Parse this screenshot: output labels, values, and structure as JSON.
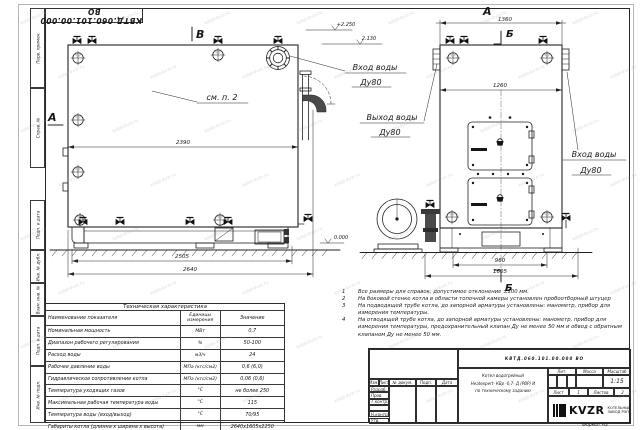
{
  "sheet": {
    "stamp_top": "КВТД.060.101.00.000 ВО",
    "format_label": "Формат  А3",
    "margin_labels": [
      "Перв. примен.",
      "Справ. №",
      "Подп. и дата",
      "Инв. № дубл.",
      "Взам. инв. №",
      "Подп. и дата",
      "Инв. № подл."
    ]
  },
  "watermark": {
    "text": "kotel-kvzr.ru"
  },
  "drawing": {
    "view_labels": {
      "b": "В",
      "a_side": "А",
      "a_front": "А",
      "sec": "Б"
    },
    "callouts": {
      "see_note": "см. п. 2",
      "inlet1": "Вход воды",
      "inlet2": "Ду80",
      "outlet1": "Выход воды",
      "outlet2": "Ду80",
      "inlet_right1": "Вход воды",
      "inlet_right2": "Ду80"
    },
    "dims": {
      "side_inner": "2390",
      "side_base": "2505",
      "side_total": "2640",
      "front_total": "1360",
      "front_inner": "1260",
      "front_base": "960",
      "front_overall": "1605"
    },
    "elevations": {
      "top": "+2.250",
      "mid": "2.130",
      "zero": "0.000"
    }
  },
  "notes": [
    {
      "num": "1",
      "text": "Все размеры для справок, допустимое отклонение ±100 мм."
    },
    {
      "num": "2",
      "text": "На боковой стенке котла в области топочной камеры установлен пробоотборный штуцер"
    },
    {
      "num": "3",
      "text": "На подводящей трубе котла, до запорной арматуры установлены: манометр, прибор для измерения температуры."
    },
    {
      "num": "4",
      "text": "На отводящей трубе котла, до запорной арматуры установлены: манометр, прибор для измерения температуры, предохранительный клапан Ду не менее 50 мм и обвод с обратным клапаном Ду не менее 50 мм."
    }
  ],
  "tech_table": {
    "title": "Техническая характеристика",
    "headers": {
      "name": "Наименование показателя",
      "units": "Единицы измерения",
      "value": "Значение"
    },
    "rows": [
      {
        "name": "Номинальная мощность",
        "units": "МВт",
        "value": "0,7"
      },
      {
        "name": "Диапазон рабочего регулирования",
        "units": "%",
        "value": "50-100"
      },
      {
        "name": "Расход воды",
        "units": "м3/ч",
        "value": "24"
      },
      {
        "name": "Рабочее давление воды",
        "units": "МПа (кгс/см2)",
        "value": "0,6 (6,0)"
      },
      {
        "name": "Гидравлическое сопротивление котла",
        "units": "МПа (кгс/см2)",
        "value": "0,06 (0,6)"
      },
      {
        "name": "Температура уходящих газов",
        "units": "°С",
        "value": "не более 250"
      },
      {
        "name": "Максимальная рабочая температура воды",
        "units": "°С",
        "value": "115"
      },
      {
        "name": "Температура воды (вход/выход)",
        "units": "°С",
        "value": "70/95"
      },
      {
        "name": "Габариты котла (длинна х ширина х высота)",
        "units": "мм",
        "value": "2640х1605х2250"
      }
    ]
  },
  "title_block": {
    "doc_number": "КВТД.060.101.00.000  ВО",
    "name_line1": "Котел водогрейный",
    "name_line2": "Heatexpert- КВр -0,7- Д (РВР) И",
    "name_line3": "по техническому заданию",
    "lit_label": "Лит.",
    "mass_label": "Масса",
    "scale_label": "Масштаб",
    "scale": "1:15",
    "sheet_label": "Лист",
    "sheet_num": "1",
    "sheets_label": "Листов",
    "sheets_num": "2",
    "sig_headers": [
      "Изм.",
      "Лист",
      "№ докум.",
      "Подп.",
      "Дата"
    ],
    "sig_rows": [
      "Разраб.",
      "Пров.",
      "Т.контр.",
      "",
      "Н.контр.",
      "Утв."
    ],
    "logo_text": "KVZR",
    "logo_cap1": "КОТЕЛЬНЫЙ",
    "logo_cap2": "ЗАВОД РЭП"
  }
}
